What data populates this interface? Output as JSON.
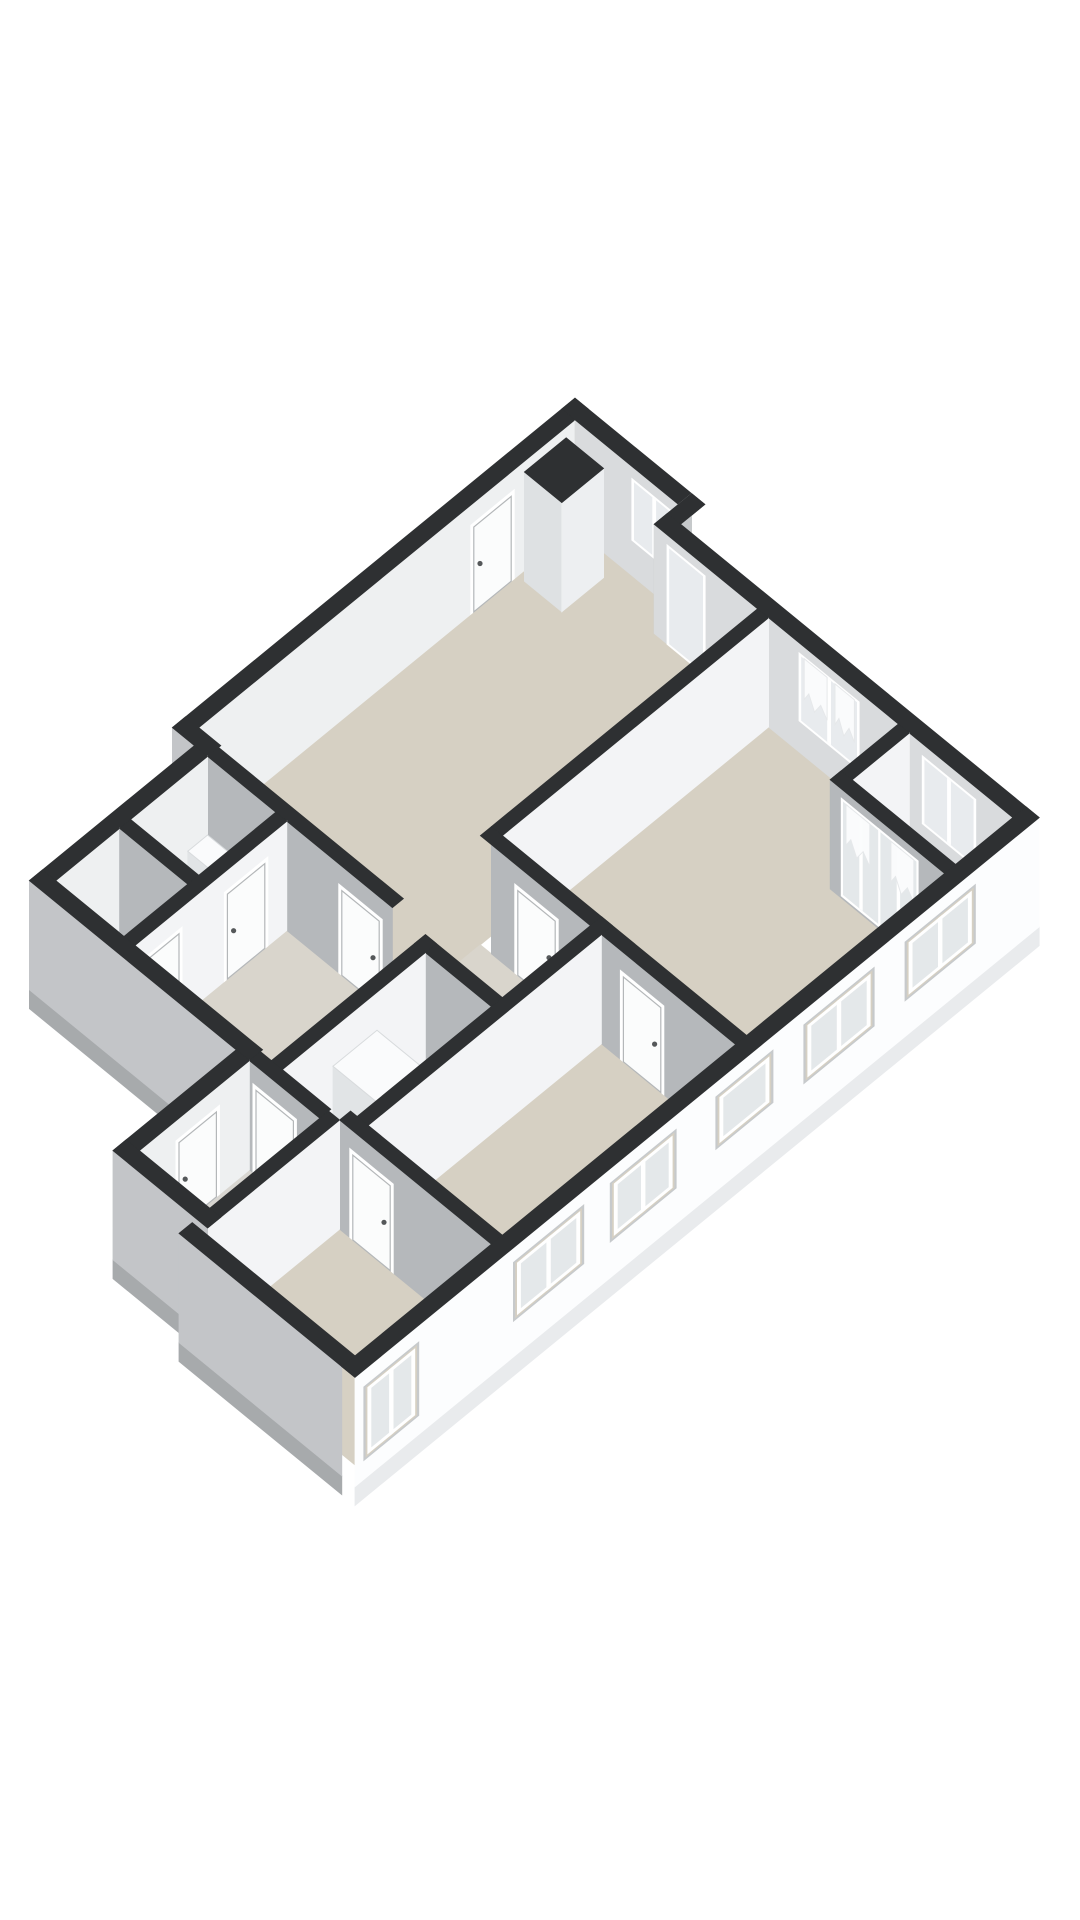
{
  "meta": {
    "view_label": "3d-floor-plan-render",
    "background": "#ffffff"
  },
  "projection": {
    "cx": 575,
    "cy": 529,
    "ax": 44,
    "ay": 36,
    "zs": 42,
    "wall_h": 2.6,
    "slab_h": 0.45
  },
  "palette": {
    "band": "#2e3032",
    "wallWhite": "#f3f4f6",
    "wallGray": "#b5b8bb",
    "wallGrayExt": "#c3c5c8",
    "facade": "#fcfdfe",
    "intTopWall": "#d9dbdd",
    "intLeftWall": "#eef0f1",
    "stepGray": "#c6c9cb",
    "slabWhite": "#e9ebed",
    "slabGray": "#a7aaac",
    "beige": "#d6d0c3",
    "beigeLight": "#dad4c8",
    "hallFloor": "#d9d5cc",
    "vestFloor": "#d8d6d1",
    "glass": "#e8ebee",
    "glassF": "#e4e8ea",
    "reveal": "#c7cacc",
    "frame": "#ffffff",
    "door": "#fbfcfc",
    "doorStroke": "#b4b7b9",
    "handle": "#55585a",
    "curtain": "#fbfcfd",
    "curtainStroke": "#e6e8ea",
    "boxTop": "#fafbfc",
    "boxU": "#f2f4f5",
    "boxV": "#e1e4e6",
    "shaftU": "#edeff1",
    "shaftV": "#dee1e3"
  },
  "floors": [
    {
      "name": "floor-living-room",
      "fill": "beige",
      "pts": [
        [
          0,
          0
        ],
        [
          2.35,
          0
        ],
        [
          2.35,
          0.55
        ],
        [
          4.7,
          0.55
        ],
        [
          4.7,
          8.6
        ],
        [
          0,
          8.6
        ]
      ]
    },
    {
      "name": "floor-bedroom-1",
      "fill": "beige",
      "pts": [
        [
          4.95,
          0.55
        ],
        [
          7.9,
          0.55
        ],
        [
          7.9,
          2.1
        ],
        [
          10.5,
          2.1
        ],
        [
          10.5,
          6.6
        ],
        [
          4.95,
          6.6
        ]
      ]
    },
    {
      "name": "floor-balcony-niche",
      "fill": "beigeLight",
      "pts": [
        [
          8.15,
          0.55
        ],
        [
          10.5,
          0.55
        ],
        [
          10.5,
          1.85
        ],
        [
          8.15,
          1.85
        ]
      ]
    },
    {
      "name": "floor-hallway",
      "fill": "hallFloor",
      "pts": [
        [
          4.7,
          6.85
        ],
        [
          7.45,
          6.85
        ],
        [
          7.45,
          8.85
        ],
        [
          5.45,
          8.85
        ],
        [
          5.45,
          12.6
        ],
        [
          2.3,
          12.6
        ],
        [
          2.3,
          8.85
        ],
        [
          4.7,
          8.85
        ]
      ]
    },
    {
      "name": "floor-bathroom",
      "fill": "beigeLight",
      "pts": [
        [
          0.5,
          8.85
        ],
        [
          2.05,
          8.85
        ],
        [
          2.05,
          10.6
        ],
        [
          0.5,
          10.6
        ]
      ]
    },
    {
      "name": "floor-toilet",
      "fill": "beigeLight",
      "pts": [
        [
          0.5,
          10.85
        ],
        [
          2.05,
          10.85
        ],
        [
          2.05,
          12.3
        ],
        [
          0.5,
          12.3
        ]
      ]
    },
    {
      "name": "floor-closet",
      "fill": "hallFloor",
      "pts": [
        [
          5.7,
          9.1
        ],
        [
          7.2,
          9.1
        ],
        [
          7.2,
          12.15
        ],
        [
          5.7,
          12.15
        ]
      ]
    },
    {
      "name": "floor-bedroom-2",
      "fill": "beige",
      "pts": [
        [
          7.45,
          6.85
        ],
        [
          10.5,
          6.85
        ],
        [
          10.5,
          12.15
        ],
        [
          7.45,
          12.15
        ]
      ]
    },
    {
      "name": "floor-vestibule",
      "fill": "vestFloor",
      "pts": [
        [
          5.2,
          12.6
        ],
        [
          6.8,
          12.6
        ],
        [
          6.8,
          15.1
        ],
        [
          5.2,
          15.1
        ]
      ]
    },
    {
      "name": "floor-bedroom-3",
      "fill": "beige",
      "pts": [
        [
          7.05,
          12.4
        ],
        [
          10.5,
          12.4
        ],
        [
          10.5,
          15.5
        ],
        [
          7.05,
          15.5
        ]
      ]
    }
  ],
  "scene": [
    {
      "type": "wall",
      "name": "wall-exterior-left",
      "axis": "v",
      "c": 0,
      "a1": 0,
      "a2": 8.85,
      "fill": "intLeftWall",
      "top": [
        -0.3,
        0,
        -0.3,
        8.85
      ],
      "features": [
        {
          "type": "door",
          "name": "door-entry-gallery",
          "a1": 1.45,
          "a2": 2.3
        }
      ]
    },
    {
      "type": "wall",
      "name": "wall-exterior-top-a",
      "axis": "u",
      "c": 0,
      "a1": 0,
      "a2": 2.35,
      "fill": "intTopWall",
      "top": [
        -0.3,
        2.65,
        -0.3,
        0
      ],
      "features": [
        {
          "type": "window",
          "name": "window-living-top",
          "a1": 1.35,
          "a2": 2.25,
          "z1": 0.9,
          "z2": 2.25,
          "mullion": true
        }
      ]
    },
    {
      "type": "wall",
      "name": "wall-porch-step",
      "axis": "v",
      "c": 2.35,
      "a1": -0.3,
      "a2": 0.55,
      "fill": "stepGray",
      "top": [
        2.35,
        2.65,
        -0.3,
        0.55
      ],
      "features": [
        {
          "type": "window",
          "name": "window-porch-sidelight",
          "a1": 0.0,
          "a2": 0.45,
          "z1": 0.12,
          "z2": 2.28,
          "mullion": false
        }
      ]
    },
    {
      "type": "wall",
      "name": "wall-exterior-top-b",
      "axis": "u",
      "c": 0.55,
      "a1": 2.35,
      "a2": 10.5,
      "fill": "intTopWall",
      "top": [
        2.35,
        10.8,
        0.25,
        0.55
      ],
      "features": [
        {
          "type": "window",
          "name": "door-glazed-entry",
          "a1": 2.7,
          "a2": 3.45,
          "z1": 0.05,
          "z2": 2.3,
          "mullion": false
        },
        {
          "type": "window",
          "name": "window-bedroom1-top",
          "a1": 5.7,
          "a2": 6.95,
          "z1": 0.8,
          "z2": 2.3,
          "mullion": true
        },
        {
          "type": "curtain",
          "name": "curtain-bedroom1-left",
          "a1": 5.76,
          "a2": 6.28
        },
        {
          "type": "curtain",
          "name": "curtain-bedroom1-right",
          "a1": 6.46,
          "a2": 6.9
        },
        {
          "type": "window",
          "name": "window-niche-top",
          "a1": 8.5,
          "a2": 9.6,
          "z1": 0.75,
          "z2": 2.25,
          "mullion": true
        }
      ]
    },
    {
      "type": "box",
      "name": "duct-shaft-column",
      "u1": 0.15,
      "v1": 0.35,
      "u2": 1.0,
      "v2": 1.3,
      "h": 2.6,
      "topFill": "band",
      "fu": "shaftU",
      "fv": "shaftV"
    },
    {
      "type": "wall",
      "name": "wall-niche-left",
      "axis": "v",
      "c": 8.15,
      "a1": 0.55,
      "a2": 1.85,
      "fill": "wallWhite",
      "top": [
        7.9,
        8.15,
        0.55,
        2.1
      ],
      "features": []
    },
    {
      "type": "wall",
      "name": "wall-french-doors",
      "axis": "u",
      "c": 2.1,
      "a1": 7.9,
      "a2": 10.5,
      "fill": "wallGray",
      "top": [
        7.9,
        10.8,
        1.85,
        2.1
      ],
      "features": [
        {
          "type": "french",
          "name": "french-door-left",
          "a1": 8.2,
          "a2": 9.0
        },
        {
          "type": "french",
          "name": "french-door-right",
          "a1": 9.05,
          "a2": 9.85
        },
        {
          "type": "curtain",
          "name": "curtain-french-left",
          "a1": 8.26,
          "a2": 8.8
        },
        {
          "type": "curtain",
          "name": "curtain-french-right",
          "a1": 9.28,
          "a2": 9.8
        }
      ]
    },
    {
      "type": "wall",
      "name": "wall-living-bedroom1",
      "axis": "v",
      "c": 4.95,
      "a1": 0.55,
      "a2": 6.6,
      "fill": "wallWhite",
      "top": [
        4.7,
        4.95,
        0.55,
        6.6
      ],
      "features": []
    },
    {
      "type": "wall",
      "name": "wall-living-hall",
      "axis": "u",
      "c": 8.85,
      "a1": 0,
      "a2": 4.7,
      "fill": "wallGray",
      "top": [
        0,
        4.7,
        8.6,
        8.85
      ],
      "features": [
        {
          "type": "door",
          "name": "door-living-hall",
          "a1": 3.55,
          "a2": 4.4
        }
      ]
    },
    {
      "type": "wall",
      "name": "wall-left-step",
      "axis": "u",
      "c": 8.85,
      "a1": -0.3,
      "a2": 0.2,
      "fill": "wallGrayExt",
      "top": [
        -0.3,
        0.5,
        8.55,
        8.85
      ],
      "features": []
    },
    {
      "type": "wall",
      "name": "wall-exterior-left-lower",
      "axis": "v",
      "c": 0.5,
      "a1": 8.85,
      "a2": 12.6,
      "fill": "intLeftWall",
      "top": [
        0.2,
        0.5,
        8.85,
        12.6
      ],
      "features": []
    },
    {
      "type": "box",
      "name": "washbasin-fixture",
      "u1": 0.6,
      "v1": 8.95,
      "u2": 1.5,
      "v2": 9.4,
      "h": 0.9,
      "topFill": "boxTop",
      "fu": "boxU",
      "fv": "boxV"
    },
    {
      "type": "wall",
      "name": "wall-bath-toilet",
      "axis": "u",
      "c": 10.85,
      "a1": 0.5,
      "a2": 2.3,
      "fill": "wallGray",
      "top": [
        0.5,
        2.3,
        10.6,
        10.85
      ],
      "features": []
    },
    {
      "type": "box",
      "name": "toilet-fixture",
      "u1": 0.75,
      "v1": 11.1,
      "u2": 1.4,
      "v2": 11.7,
      "h": 0.55,
      "topFill": "boxTop",
      "fu": "boxU",
      "fv": "boxV"
    },
    {
      "type": "wall",
      "name": "wall-bath-hall",
      "axis": "v",
      "c": 2.3,
      "a1": 8.85,
      "a2": 12.6,
      "fill": "wallWhite",
      "top": [
        2.05,
        2.3,
        8.85,
        12.6
      ],
      "features": [
        {
          "type": "door",
          "name": "door-bathroom",
          "a1": 9.35,
          "a2": 10.2
        },
        {
          "type": "door",
          "name": "door-toilet",
          "a1": 11.3,
          "a2": 12.15
        }
      ]
    },
    {
      "type": "wall",
      "name": "wall-bedroom1-hall",
      "axis": "u",
      "c": 6.85,
      "a1": 4.95,
      "a2": 10.5,
      "fill": "wallGray",
      "top": [
        4.7,
        10.8,
        6.6,
        6.85
      ],
      "features": [
        {
          "type": "door",
          "name": "door-bedroom-1",
          "a1": 5.55,
          "a2": 6.4
        },
        {
          "type": "door",
          "name": "door-bedroom-2",
          "a1": 7.95,
          "a2": 8.8
        }
      ]
    },
    {
      "type": "wall",
      "name": "wall-closet-top",
      "axis": "u",
      "c": 9.1,
      "a1": 5.45,
      "a2": 7.45,
      "fill": "wallGray",
      "top": [
        5.45,
        7.45,
        8.85,
        9.1
      ],
      "features": []
    },
    {
      "type": "wall",
      "name": "wall-hall-closet",
      "axis": "v",
      "c": 5.7,
      "a1": 9.1,
      "a2": 12.35,
      "fill": "wallWhite",
      "top": [
        5.45,
        5.7,
        8.85,
        12.6
      ],
      "features": []
    },
    {
      "type": "box",
      "name": "water-heater-unit",
      "u1": 5.85,
      "v1": 10.35,
      "u2": 6.85,
      "v2": 11.35,
      "h": 1.95,
      "topFill": "boxTop",
      "fu": "boxU",
      "fv": "boxV"
    },
    {
      "type": "wall",
      "name": "wall-closet-bedroom2",
      "axis": "v",
      "c": 7.45,
      "a1": 6.85,
      "a2": 12.15,
      "fill": "wallWhite",
      "top": [
        7.2,
        7.45,
        6.6,
        12.4
      ],
      "features": []
    },
    {
      "type": "wall",
      "name": "wall-exterior-toilet-bottom",
      "axis": "u",
      "c": 12.6,
      "a1": 0.2,
      "a2": 4.9,
      "fill": "wallGrayExt",
      "slab": "slabGray",
      "top": [
        0.2,
        5.2,
        12.3,
        12.6
      ],
      "features": []
    },
    {
      "type": "wall",
      "name": "wall-hall-vestibule",
      "axis": "u",
      "c": 12.6,
      "a1": 5.2,
      "a2": 6.8,
      "fill": "wallGray",
      "top": [
        5.2,
        6.8,
        12.35,
        12.6
      ],
      "features": [
        {
          "type": "door",
          "name": "door-vestibule-hall",
          "a1": 5.35,
          "a2": 6.2
        }
      ]
    },
    {
      "type": "wall",
      "name": "wall-vestibule-left",
      "axis": "v",
      "c": 5.2,
      "a1": 12.6,
      "a2": 15.1,
      "fill": "intLeftWall",
      "top": [
        4.9,
        5.2,
        12.6,
        15.4
      ],
      "features": [
        {
          "type": "door",
          "name": "door-main-entrance",
          "a1": 13.35,
          "a2": 14.2
        }
      ]
    },
    {
      "type": "wall",
      "name": "wall-bedroom3-top",
      "axis": "u",
      "c": 12.4,
      "a1": 7.05,
      "a2": 10.5,
      "fill": "wallGray",
      "top": [
        7.05,
        10.8,
        12.15,
        12.4
      ],
      "features": [
        {
          "type": "door",
          "name": "door-bedroom-3",
          "a1": 7.35,
          "a2": 8.2
        }
      ]
    },
    {
      "type": "wall",
      "name": "wall-vestibule-bedroom3",
      "axis": "v",
      "c": 7.05,
      "a1": 12.4,
      "a2": 15.5,
      "fill": "wallWhite",
      "top": [
        6.8,
        7.05,
        12.4,
        15.8
      ],
      "features": []
    },
    {
      "type": "wall",
      "name": "wall-exterior-vestibule-bottom",
      "axis": "u",
      "c": 15.4,
      "a1": 4.9,
      "a2": 7.05,
      "fill": "wallGrayExt",
      "slab": "slabGray",
      "top": [
        4.9,
        7.05,
        15.1,
        15.4
      ],
      "features": []
    },
    {
      "type": "wall",
      "name": "wall-exterior-bottom",
      "axis": "u",
      "c": 15.8,
      "a1": 6.8,
      "a2": 10.5,
      "fill": "wallGrayExt",
      "slab": "slabGray",
      "top": [
        6.8,
        10.8,
        15.5,
        15.8
      ],
      "features": []
    },
    {
      "type": "wall",
      "name": "wall-exterior-facade",
      "axis": "v",
      "c": 10.8,
      "a1": 0.25,
      "a2": 15.8,
      "fill": "facade",
      "slab": "slabWhite",
      "top": [
        10.5,
        10.8,
        0.25,
        15.8
      ],
      "features": [
        {
          "type": "fwindow",
          "name": "facade-window-niche",
          "a1": 1.7,
          "a2": 3.3,
          "z1": 0.85,
          "z2": 2.25,
          "mullion": true
        },
        {
          "type": "fwindow",
          "name": "facade-window-bedroom1",
          "a1": 4.0,
          "a2": 5.6,
          "z1": 0.85,
          "z2": 2.25,
          "mullion": true
        },
        {
          "type": "fwindow",
          "name": "facade-window-small",
          "a1": 6.3,
          "a2": 7.6,
          "z1": 1.0,
          "z2": 2.25,
          "mullion": false
        },
        {
          "type": "fwindow",
          "name": "facade-window-bedroom2-a",
          "a1": 8.5,
          "a2": 10.0,
          "z1": 0.85,
          "z2": 2.25,
          "mullion": true
        },
        {
          "type": "fwindow",
          "name": "facade-window-bedroom2-b",
          "a1": 10.6,
          "a2": 12.2,
          "z1": 0.85,
          "z2": 2.25,
          "mullion": true
        },
        {
          "type": "fwindow",
          "name": "facade-window-bedroom3",
          "a1": 14.35,
          "a2": 15.6,
          "z1": 0.45,
          "z2": 2.2,
          "mullion": true
        }
      ]
    }
  ]
}
